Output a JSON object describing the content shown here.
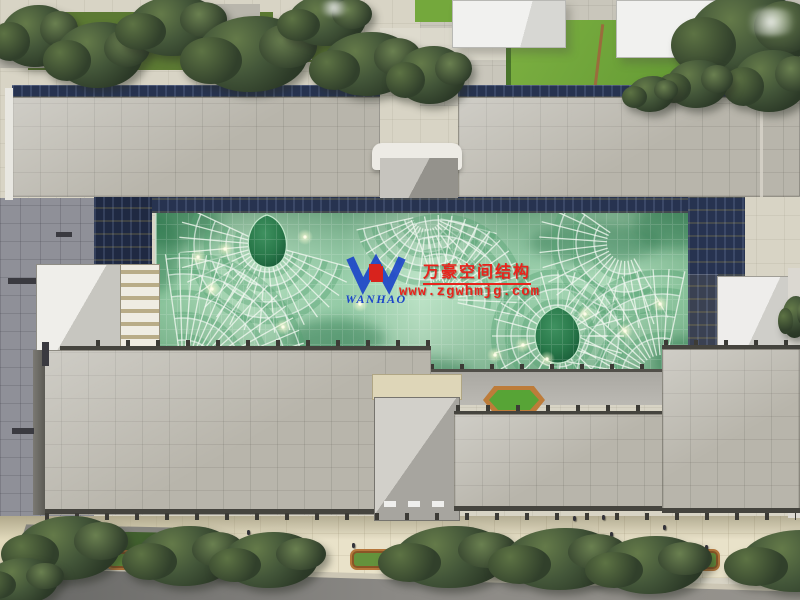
{
  "meta": {
    "description": "Aerial architectural rendering: building complex with free-form green glass canopy atrium, gray tiled roofs, dark blue glazed bands, landscaped plaza, street trees and road"
  },
  "watermark": {
    "logo_text": "WANHAO",
    "logo_mark": "PJ",
    "company_name_cn": "万豪空间结构",
    "website": "www.zgwhmjg.com",
    "text_color": "#e8241c",
    "logo_blue": "#1c45c8",
    "logo_red": "#d8231d"
  },
  "colors": {
    "plaza": "#d8d4c5",
    "sidewalk": "#e9e2c9",
    "road_dark": "#666664",
    "road_light": "#96938d",
    "roof_light": "#cecbc1",
    "roof_dark": "#b2afa5",
    "glazing_blue": "#273350",
    "canopy_base": "#9bd0aa",
    "canopy_mid": "#56a372",
    "canopy_dark": "#1f6b41",
    "canopy_rib": "#f0f8ef",
    "tree_dark": "#2d3b28",
    "grass": "#74a83c",
    "planter_wood": "#bd7c3a",
    "white_building": "#f1f1ef"
  }
}
